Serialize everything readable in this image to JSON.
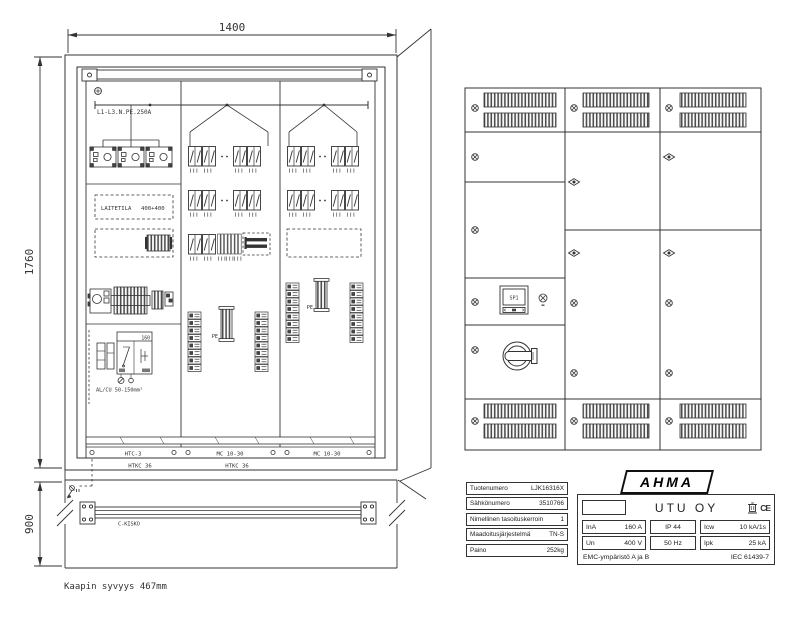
{
  "left_view": {
    "dim_top": "1400",
    "dim_left": "1760",
    "dim_base": "900",
    "busbar": "L1-L3.N.PE.250A",
    "laitetila": "LAITETILA",
    "laitetila_size": "400+400",
    "switch_rating": "160",
    "cable_spec": "AL/CU 50-150mm²",
    "pe": "PE",
    "rails": [
      "HTC-3",
      "MC 10-30",
      "MC 10-30"
    ],
    "frames": [
      "HTKC 36",
      "HTKC 36"
    ],
    "c_rail": "C-KISKO",
    "depth_note": "Kaapin syvyys 467mm"
  },
  "front_view": {
    "display": "SP1"
  },
  "spec_table": {
    "rows": [
      {
        "label": "Tuotenumero",
        "value": "LJK16316X"
      },
      {
        "label": "Sähkönumero",
        "value": "3510766"
      },
      {
        "label": "Nimellinen tasoituskerroin",
        "value": "1"
      },
      {
        "label": "Maadoitusjärjestelmä",
        "value": "TN-S"
      },
      {
        "label": "Paino",
        "value": "252kg"
      }
    ]
  },
  "nameplate": {
    "brand": "AHMA",
    "company": "UTU OY",
    "ce": "CE",
    "row1": [
      {
        "l": "InA",
        "v": "160 A"
      },
      {
        "v": "IP 44"
      },
      {
        "l": "Icw",
        "v": "10 kA/1s"
      }
    ],
    "row2": [
      {
        "l": "Un",
        "v": "400 V"
      },
      {
        "v": "50 Hz"
      },
      {
        "l": "Ipk",
        "v": "25 kA"
      }
    ],
    "footer_left": "EMC-ympäristö A ja B",
    "footer_right": "IEC 61439-7"
  }
}
